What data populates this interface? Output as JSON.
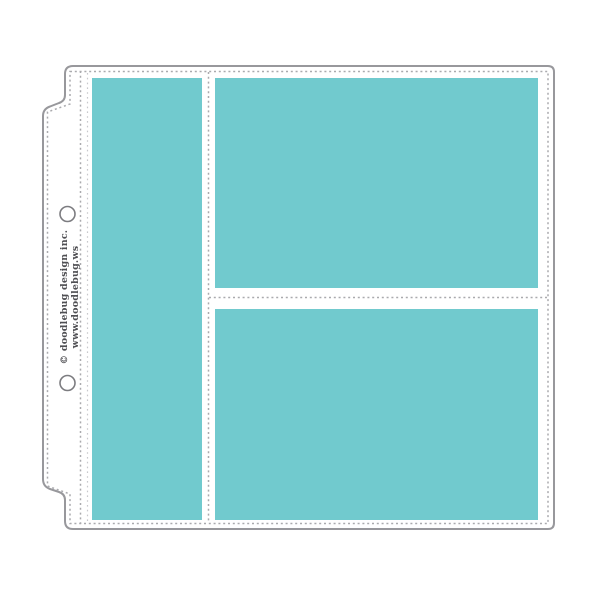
{
  "product": {
    "name": "page-protector-with-pocket-inserts",
    "branding": {
      "line1": "© doodlebug design inc.",
      "line2": "www.doodlebug.ws"
    },
    "pockets": [
      {
        "id": "left-tall-pocket"
      },
      {
        "id": "top-right-pocket"
      },
      {
        "id": "bottom-right-pocket"
      }
    ],
    "hole_count": 2
  },
  "colors": {
    "pocket_teal": "#71cace",
    "outline_gray": "#98989c",
    "stitch_gray": "#aaaaae",
    "stitch_light_gray": "#c8c8cc",
    "hole_ring_gray": "#7c7c80",
    "text_gray": "#4f4f53",
    "sheet_white": "#ffffff",
    "background_white": "#ffffff"
  }
}
